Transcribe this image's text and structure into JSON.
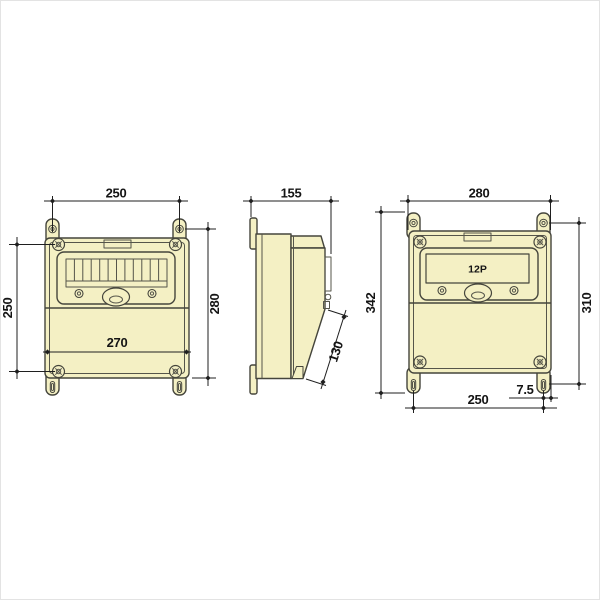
{
  "colors": {
    "background": "#ffffff",
    "enclosure_fill": "#f4f0c4",
    "outline": "#45453c",
    "dimension_lines": "#1f1f1f",
    "page_border": "#e3e3e3"
  },
  "views": {
    "front_left": {
      "dim_top_width": "250",
      "dim_left_height": "250",
      "dim_right_height": "280",
      "dim_inner_width": "270"
    },
    "side": {
      "dim_depth": "155",
      "dim_cover_slope": "130"
    },
    "front_right": {
      "cover_label": "12P",
      "dim_top_width": "280",
      "dim_left_height": "342",
      "dim_right_height": "310",
      "dim_bottom_width": "250",
      "dim_hole_offset": "7.5"
    }
  }
}
